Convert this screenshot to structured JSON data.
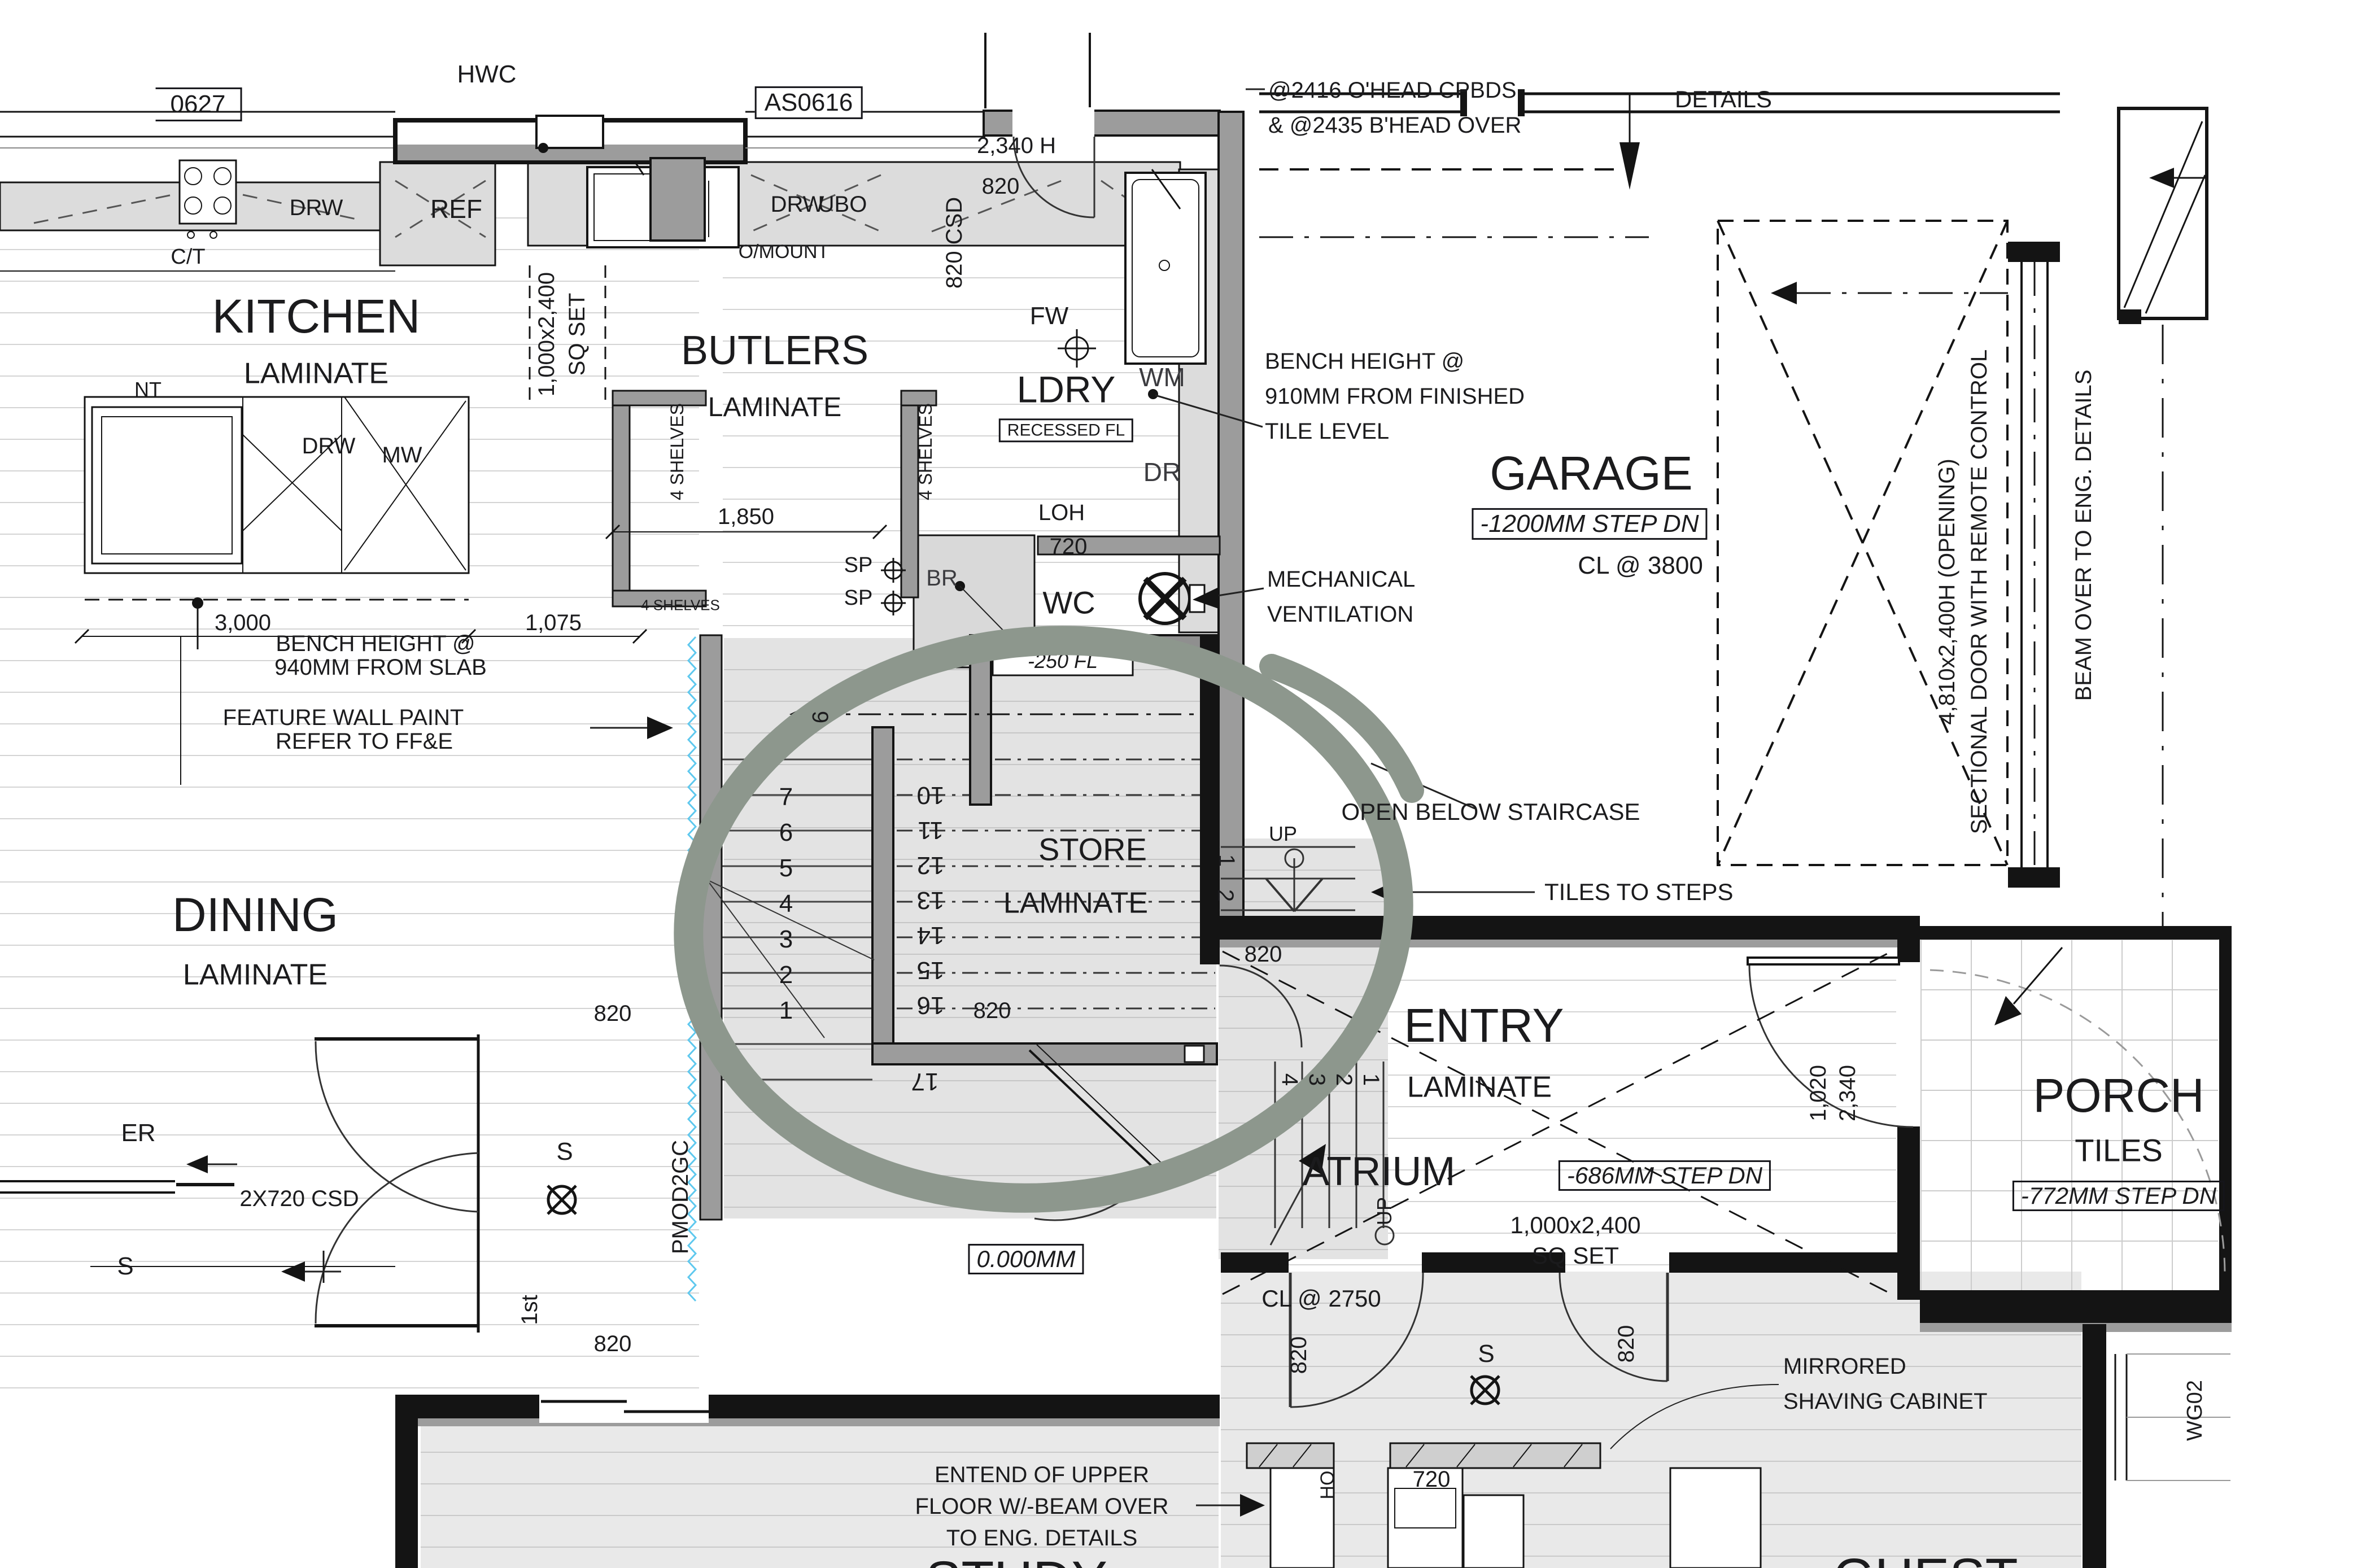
{
  "title_row": {
    "box_left": "0627",
    "hwc": "HWC",
    "box_right": "AS0616",
    "details": "DETAILS"
  },
  "kitchen": {
    "name": "KITCHEN",
    "finish": "LAMINATE",
    "drw_bench": "DRW",
    "ref": "REF",
    "drw_butlers": "DRW",
    "ubo": "UBO",
    "omount": "O/MOUNT",
    "ct": "C/T",
    "nt": "NT",
    "island_drw": "DRW",
    "island_mw": "MW",
    "sqset_l1": "1,000x2,400",
    "sqset_l2": "SQ SET",
    "dim_3000": "3,000",
    "dim_1075": "1,075",
    "bench_note_l1": "BENCH HEIGHT @",
    "bench_note_l2": "940MM FROM SLAB",
    "feature_l1": "FEATURE WALL PAINT",
    "feature_l2": "REFER TO FF&E"
  },
  "butlers": {
    "name": "BUTLERS",
    "finish": "LAMINATE",
    "shelves_left": "4 SHELVES",
    "shelves_right": "4 SHELVES",
    "shelves_bottom": "4 SHELVES",
    "dim_1850": "1,850",
    "sp1": "SP",
    "sp2": "SP",
    "br": "BR"
  },
  "dining": {
    "name": "DINING",
    "finish": "LAMINATE",
    "er": "ER"
  },
  "laundry": {
    "name": "LDRY",
    "recessed": "RECESSED FL",
    "fw": "FW",
    "wm": "WM",
    "dr": "DR",
    "loh": "LOH",
    "loh_720": "720",
    "dim_2340h": "2,340 H",
    "door_820": "820",
    "csd_820": "820 CSD",
    "wc": "WC",
    "wc_step": "-250 FL"
  },
  "garage": {
    "name": "GARAGE",
    "step": "-1200MM STEP DN",
    "cl": "CL @ 3800",
    "ohead_l1": "@2416 O'HEAD CPBDS",
    "ohead_l2": "& @2435 B'HEAD OVER",
    "bench_l1": "BENCH HEIGHT @",
    "bench_l2": "910MM FROM FINISHED",
    "bench_l3": "TILE LEVEL",
    "mech_l1": "MECHANICAL",
    "mech_l2": "VENTILATION",
    "door_l1": "4,810x2,400H  (OPENING)",
    "door_l2": "SECTIONAL DOOR WITH REMOTE CONTROL",
    "beam": "BEAM OVER TO ENG. DETAILS"
  },
  "stairs": {
    "store": "STORE",
    "store_finish": "LAMINATE",
    "open_below": "OPEN BELOW STAIRCASE",
    "tiles_to_steps": "TILES TO STEPS",
    "up1": "UP",
    "up2": "UP",
    "flight_down": [
      "7",
      "6",
      "5",
      "4",
      "3",
      "2",
      "1"
    ],
    "flight_up": [
      "10",
      "11",
      "12",
      "13",
      "14",
      "15",
      "16"
    ],
    "n17": "17",
    "n9": "9",
    "landing_steps": [
      "1",
      "2"
    ],
    "entry_steps": [
      "4",
      "3",
      "2",
      "1"
    ],
    "door_820_store": "820",
    "door_820_right": "820"
  },
  "entry": {
    "name": "ENTRY",
    "finish": "LAMINATE",
    "atrium": "ATRIUM",
    "step_686": "-686MM STEP DN",
    "sqset_l1": "1,000x2,400",
    "sqset_l2": "SQ SET",
    "level": "0.000MM",
    "door_1020": "1,020",
    "door_2340": "2,340"
  },
  "porch": {
    "name": "PORCH",
    "finish": "TILES",
    "step_772": "-772MM STEP DN",
    "wg02": "WG02"
  },
  "bottom": {
    "csd": "2X720 CSD",
    "s_left": "S",
    "s_mid": "S",
    "s_bath": "S",
    "first_floor": "1st",
    "pmod": "PMOD2GC",
    "door_820_a": "820",
    "door_820_b": "820",
    "extend_l1": "ENTEND OF UPPER",
    "extend_l2": "FLOOR W/-BEAM OVER",
    "extend_l3": "TO ENG. DETAILS",
    "study": "STUDY",
    "guest": "GUEST",
    "cl_2750": "CL @ 2750",
    "mirror_l1": "MIRRORED",
    "mirror_l2": "SHAVING CABINET",
    "bath_820_a": "820",
    "bath_820_b": "820",
    "dim_720": "720",
    "ho": "HO"
  },
  "colors": {
    "highlight_circle": "#8d978d",
    "feature_zigzag": "#5ec8ee",
    "wall": "#141414",
    "wall_grey": "#9c9c9c",
    "floor_line": "#d4d4d4"
  },
  "icons": {
    "fan": "mechanical-fan-icon",
    "switch": "light-switch-icon",
    "crosshair": "ceiling-point-icon",
    "up_marker": "stair-up-marker-icon"
  }
}
